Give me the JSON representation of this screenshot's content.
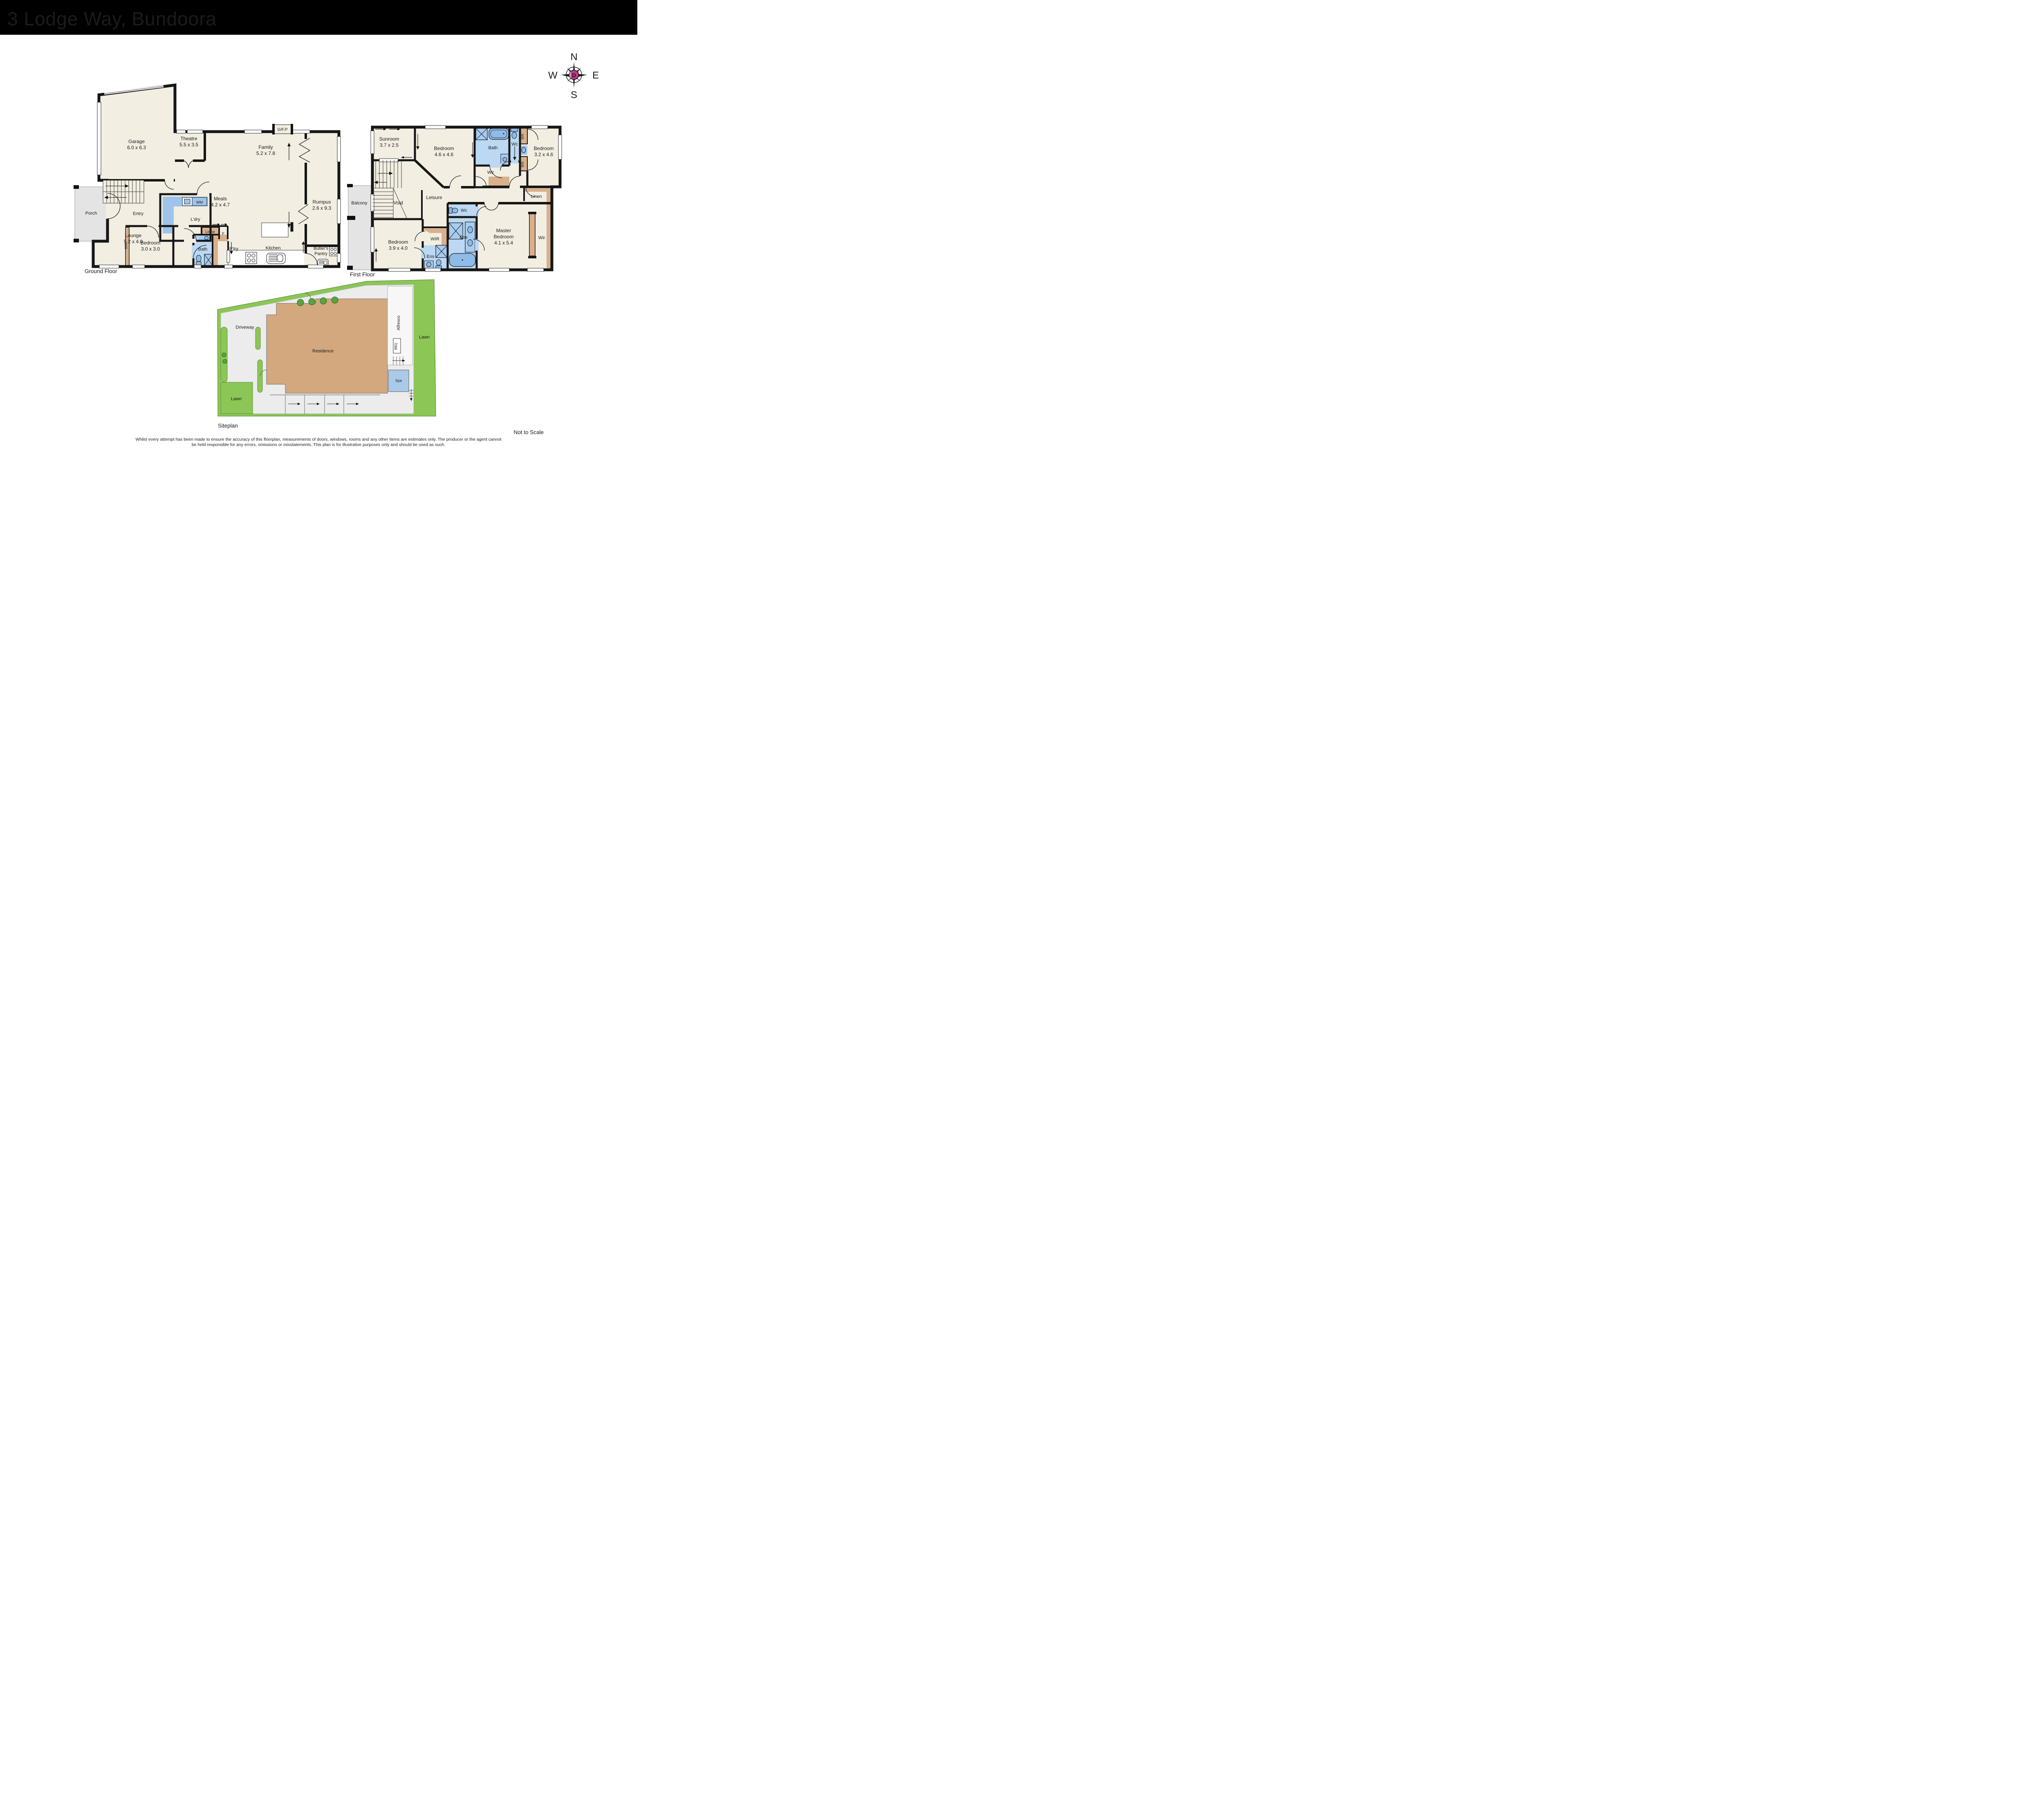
{
  "header": {
    "title": "3 Lodge Way, Bundoora"
  },
  "compass": {
    "north": "N",
    "east": "E",
    "south": "S",
    "west": "W",
    "brand_letter": "D",
    "brand_color": "#C0378F"
  },
  "ground_floor": {
    "caption": "Ground Floor",
    "garage": {
      "name": "Garage",
      "dims": "6.0 x 6.3"
    },
    "theatre": {
      "name": "Theatre",
      "dims": "5.5 x 3.5"
    },
    "family": {
      "name": "Family",
      "dims": "5.2 x 7.8"
    },
    "meals": {
      "name": "Meals",
      "dims": "4.2 x 4.7"
    },
    "rumpus": {
      "name": "Rumpus",
      "dims": "2.6 x 9.3"
    },
    "lounge": {
      "name": "Lounge",
      "dims": "5.2 x 4.0"
    },
    "bedroom": {
      "name": "Bedroom",
      "dims": "3.0 x 3.0"
    },
    "porch": "Porch",
    "entry": "Entry",
    "laundry": "L'dry",
    "linen": "Linne",
    "fridge": "F",
    "bath": "Bath",
    "pantry": "P'try",
    "kitchen": "Kitchen",
    "butlers_pantry": {
      "line1": "Butler's",
      "line2": "Pantry"
    },
    "fireplace": "G/F.P",
    "bir": "BIR",
    "wm": "WM"
  },
  "first_floor": {
    "caption": "First Floor",
    "sunroom": {
      "name": "Sunroom",
      "dims": "3.7 x 2.5"
    },
    "bedroom_46": {
      "name": "Bedroom",
      "dims": "4.6 x 4.6"
    },
    "bedroom_32": {
      "name": "Bedroom",
      "dims": "3.2 x 4.6"
    },
    "bedroom_39": {
      "name": "Bedroom",
      "dims": "3.9 x 4.0"
    },
    "master": {
      "line1": "Master",
      "line2": "Bedroom",
      "dims": "4.1 x 5.4"
    },
    "bath": "Bath",
    "wc_top": "Wc",
    "wc_mid": "Wc",
    "wir_top": "Wir",
    "wir_mid": "WIR",
    "wir_master": "Wir",
    "linen": "Linen",
    "leisure": "Leisure",
    "void": "Void",
    "balcony": "Balcony",
    "ens_large": "Ens",
    "ens_small": "Ens",
    "bir_top": "BIR",
    "bir_bottom": "BIR"
  },
  "siteplan": {
    "caption": "Siteplan",
    "driveway": "Driveway",
    "residence": "Residence",
    "lawn_right": "Lawn",
    "lawn_bottom": "Lawn",
    "alfresco": "Alfresco",
    "bbq": "BBQ",
    "spa": "Spa"
  },
  "footer": {
    "not_to_scale": "Not to Scale",
    "disclaimer_line1": "Whilst every attempt has been made to ensure the accuracy of this floorplan, measurements of doors, windows, rooms and any other items are estimates only. The producer or the agent cannot",
    "disclaimer_line2": "be held responsible for any errors, omissions or misstatements. This plan is for illustrative purposes only and should be used as such."
  }
}
